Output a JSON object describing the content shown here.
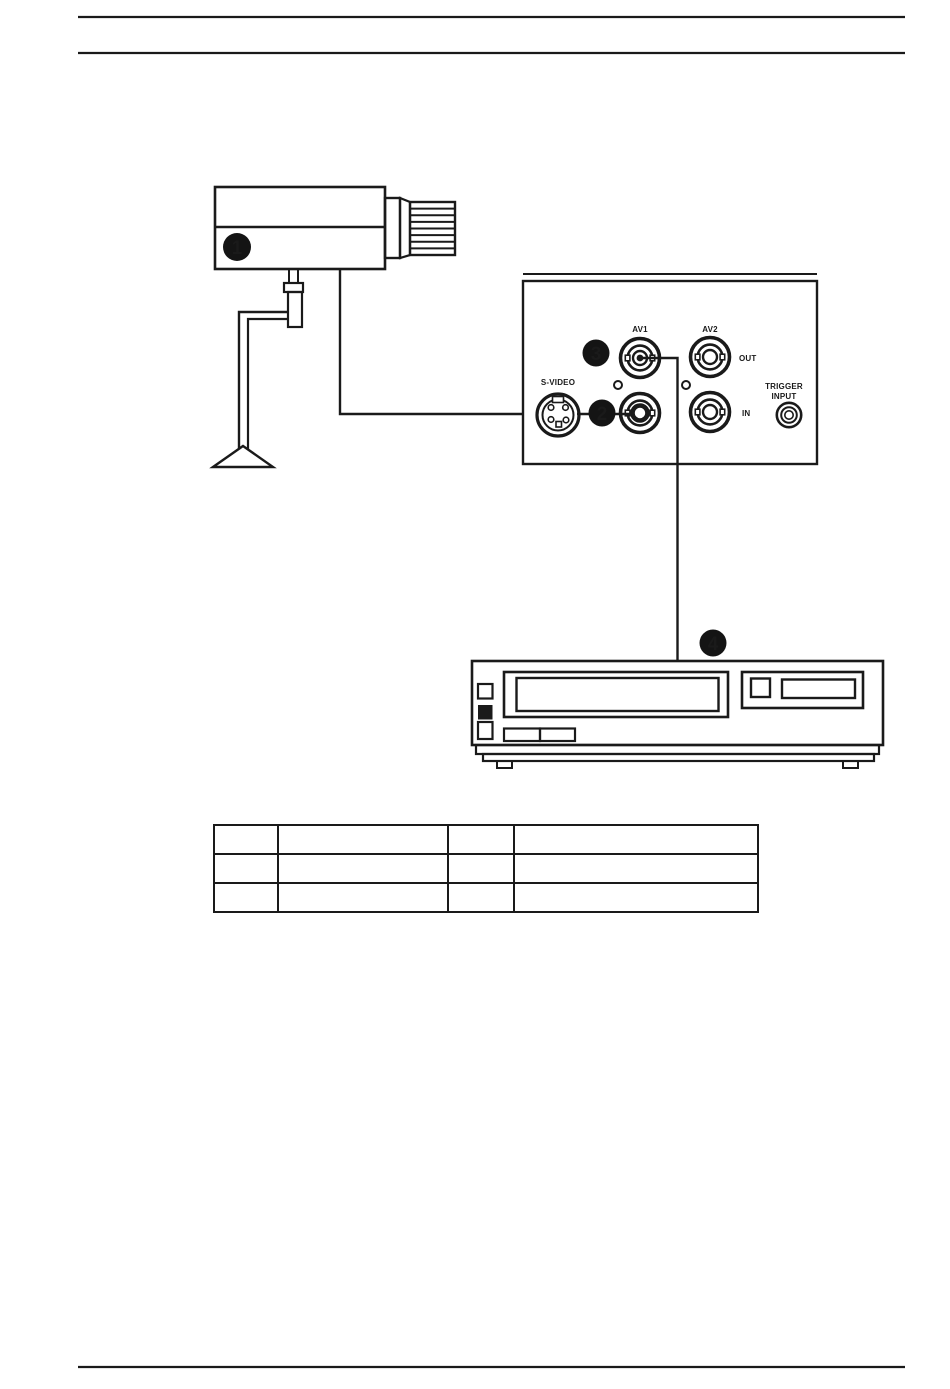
{
  "colors": {
    "background": "#ffffff",
    "ink": "#1a1a1a",
    "badge_bg": "#141414",
    "badge_text": "#ffffff"
  },
  "callouts": [
    {
      "number": "1",
      "target": "camera"
    },
    {
      "number": "2",
      "target": "av1-video-in-connector"
    },
    {
      "number": "3",
      "target": "av1-video-out-connector"
    },
    {
      "number": "4",
      "target": "video-recorder"
    }
  ],
  "panel": {
    "labels": {
      "av1": "AV1",
      "av2": "AV2",
      "out": "OUT",
      "in": "IN",
      "svideo": "S-VIDEO",
      "trigger_line1": "TRIGGER",
      "trigger_line2": "INPUT"
    }
  },
  "table": {
    "columns": 4,
    "rows": [
      [
        "",
        "",
        "",
        ""
      ],
      [
        "",
        "",
        "",
        ""
      ],
      [
        "",
        "",
        "",
        ""
      ]
    ]
  }
}
